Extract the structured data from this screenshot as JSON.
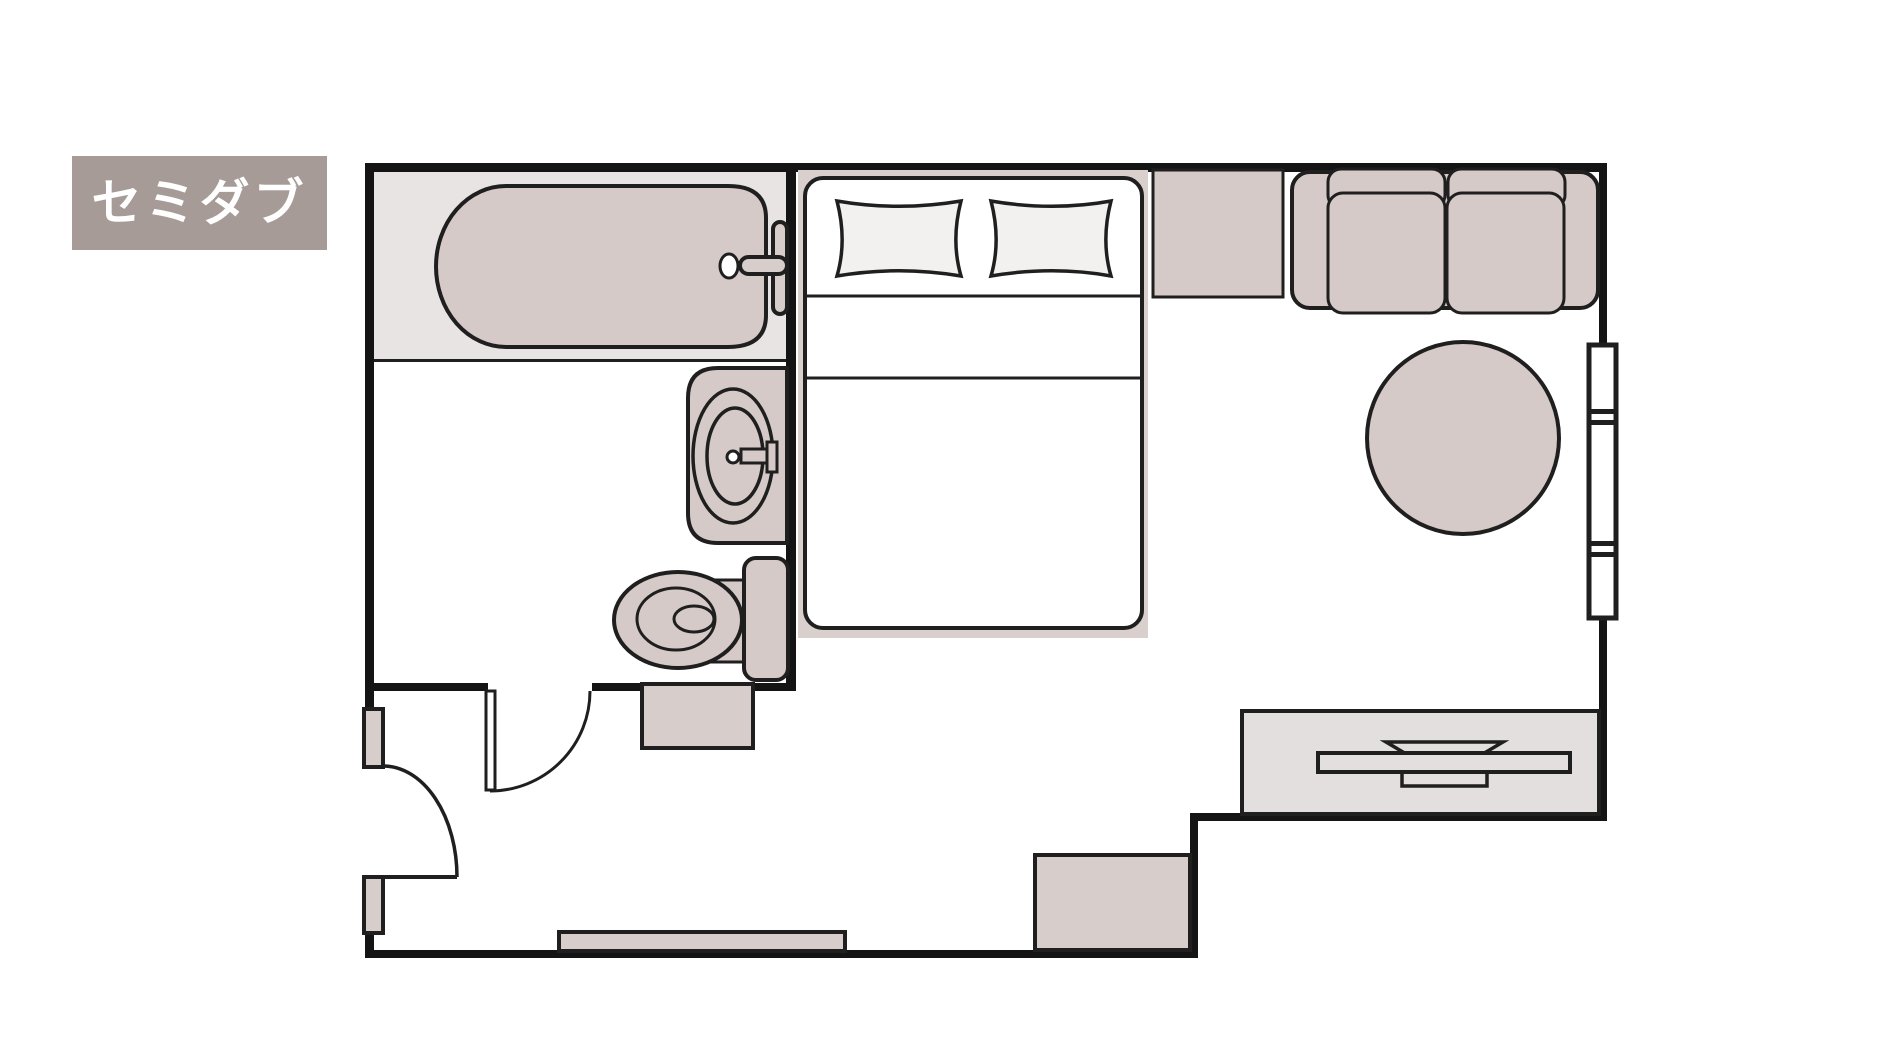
{
  "room_label": {
    "text": "セミダブル"
  },
  "palette": {
    "page_bg": "#ffffff",
    "wall": "#141414",
    "outline": "#1f1f1f",
    "furniture": "#d5cac7",
    "floor_band": "#e8e4e3",
    "cabinet": "#e3dfde",
    "fixture": "#d7cdca",
    "bed_backdrop": "#d9cfcd",
    "pillow_fill": "#f2f1f0",
    "bed_fill": "#ffffff",
    "label_bg": "#a69b97",
    "label_text": "#ffffff"
  },
  "floor_plan": {
    "furniture_icons": [
      "bathtub-icon",
      "bath-faucet-icon",
      "washbasin-icon",
      "toilet-icon",
      "double-bed-icon",
      "pillow-icon",
      "sofa-icon",
      "round-table-icon",
      "side-counter-icon",
      "tv-board-icon",
      "tv-icon",
      "window-icon",
      "entrance-door-icon",
      "interior-door-icon",
      "hall-storage-icon",
      "storage-bench-icon",
      "entrance-step-icon"
    ]
  }
}
